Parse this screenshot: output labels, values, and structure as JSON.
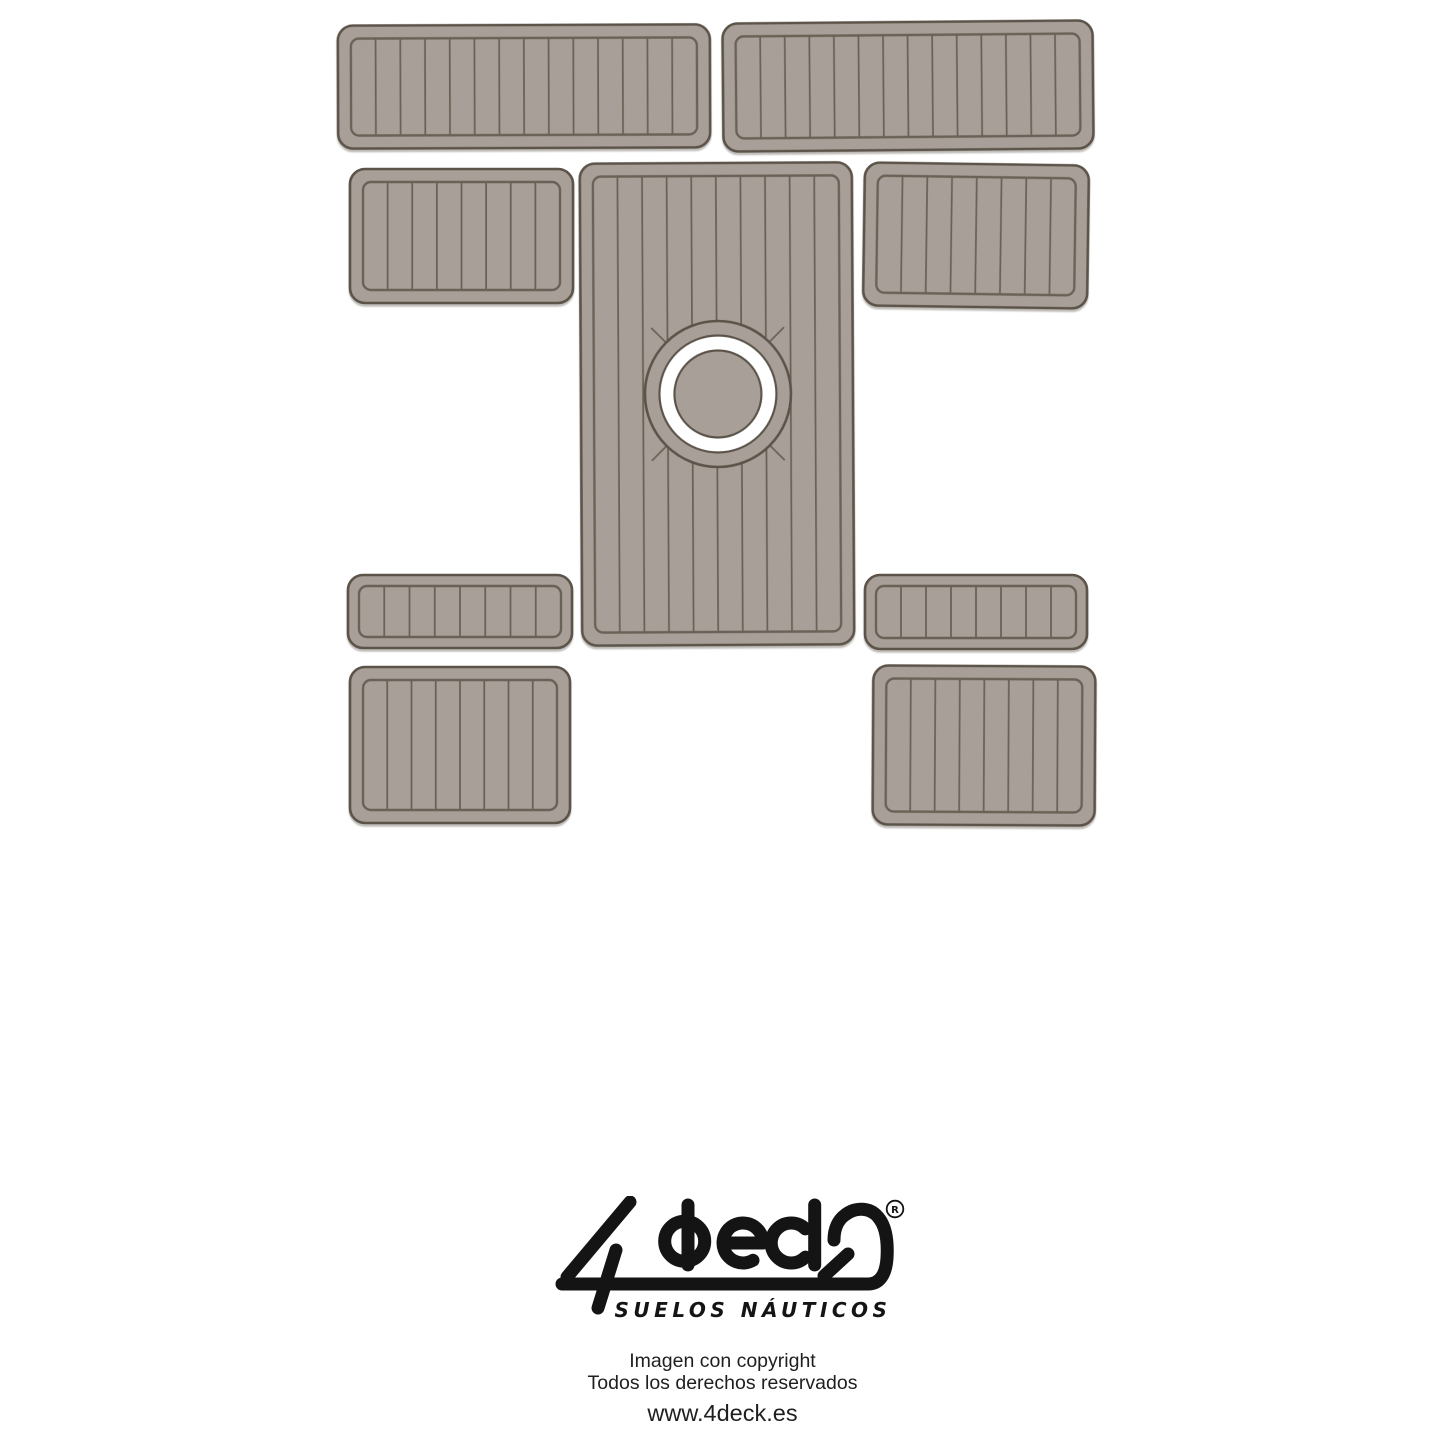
{
  "page": {
    "width": 1445,
    "height": 1445,
    "background": "#ffffff"
  },
  "artwork": {
    "description": "Boat EVA-foam deck pad template set, nine pieces with plank grooves",
    "pad_fill": "#a8a098",
    "pad_outer_stroke": "#5b5349",
    "pad_inner_stroke": "#6b6257",
    "plank_line_color": "#6b6257",
    "ring_white": "#ffffff",
    "pads": [
      {
        "id": "top-left",
        "x": 338,
        "y": 25,
        "w": 372,
        "h": 123,
        "planks": 14,
        "tilt": -0.2
      },
      {
        "id": "top-right",
        "x": 723,
        "y": 22,
        "w": 370,
        "h": 128,
        "planks": 14,
        "tilt": -0.5
      },
      {
        "id": "mid-left",
        "x": 350,
        "y": 169,
        "w": 223,
        "h": 134,
        "planks": 8,
        "tilt": 0
      },
      {
        "id": "center-console",
        "x": 581,
        "y": 163,
        "w": 272,
        "h": 482,
        "planks": 10,
        "tilt": -0.3,
        "circle": true
      },
      {
        "id": "mid-right",
        "x": 864,
        "y": 164,
        "w": 224,
        "h": 143,
        "planks": 8,
        "tilt": 0.8
      },
      {
        "id": "small-left",
        "x": 348,
        "y": 575,
        "w": 224,
        "h": 73,
        "planks": 8,
        "tilt": 0
      },
      {
        "id": "small-right",
        "x": 865,
        "y": 575,
        "w": 222,
        "h": 74,
        "planks": 8,
        "tilt": 0
      },
      {
        "id": "bottom-left",
        "x": 350,
        "y": 667,
        "w": 220,
        "h": 156,
        "planks": 8,
        "tilt": 0
      },
      {
        "id": "bottom-right",
        "x": 873,
        "y": 666,
        "w": 222,
        "h": 159,
        "planks": 8,
        "tilt": 0.3
      }
    ],
    "hatch_circle": {
      "cx": 718,
      "cy": 394,
      "r_outer": 73,
      "r_white": 58.5,
      "r_inner": 43.5
    }
  },
  "logo": {
    "brand": "4deck",
    "registered_mark": "R",
    "tagline": "SUELOS NÁUTICOS",
    "color": "#141414"
  },
  "footer": {
    "line1": "Imagen con copyright",
    "line2": "Todos los derechos reservados",
    "website": "www.4deck.es"
  }
}
